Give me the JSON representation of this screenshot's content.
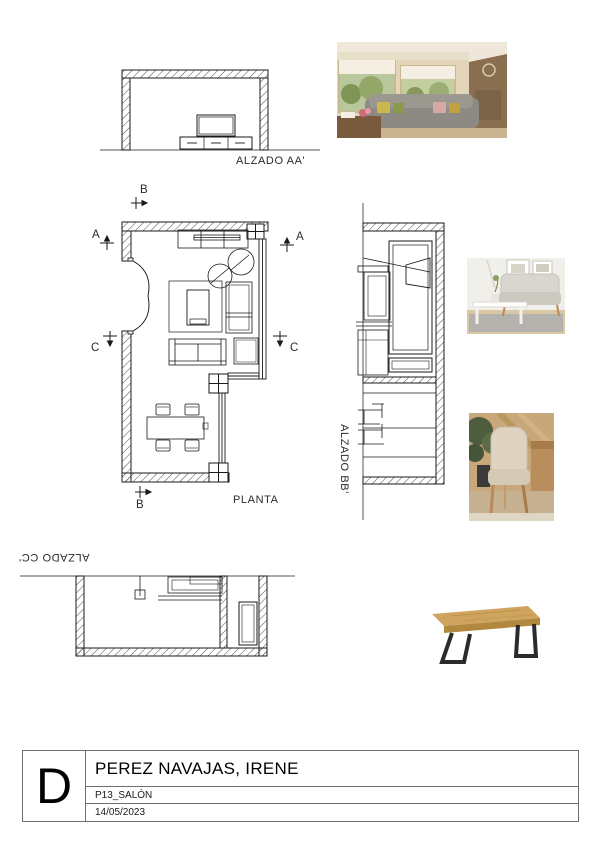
{
  "sheet": {
    "revision_letter": "D",
    "client_name": "PEREZ NAVAJAS, IRENE",
    "project_code": "P13_SALÓN",
    "date": "14/05/2023"
  },
  "drawings": {
    "elevation_aa_label": "ALZADO AA'",
    "plan_label": "PLANTA",
    "elevation_bb_label": "ALZADO BB'",
    "elevation_cc_label": "ALZADO CC'"
  },
  "section_markers": {
    "a": "A",
    "b": "B",
    "c": "C"
  },
  "photos": {
    "living_room": "living-room-inspiration-photo",
    "sofa": "sofa-reference-photo",
    "dining_chair": "dining-chair-reference-photo",
    "dining_table": "dining-table-reference-photo"
  },
  "colors": {
    "linework": "#1a1a1a",
    "titleblock_border": "#6e6e6e",
    "wood": "#c99e55",
    "leg_black": "#2b2b2b"
  }
}
